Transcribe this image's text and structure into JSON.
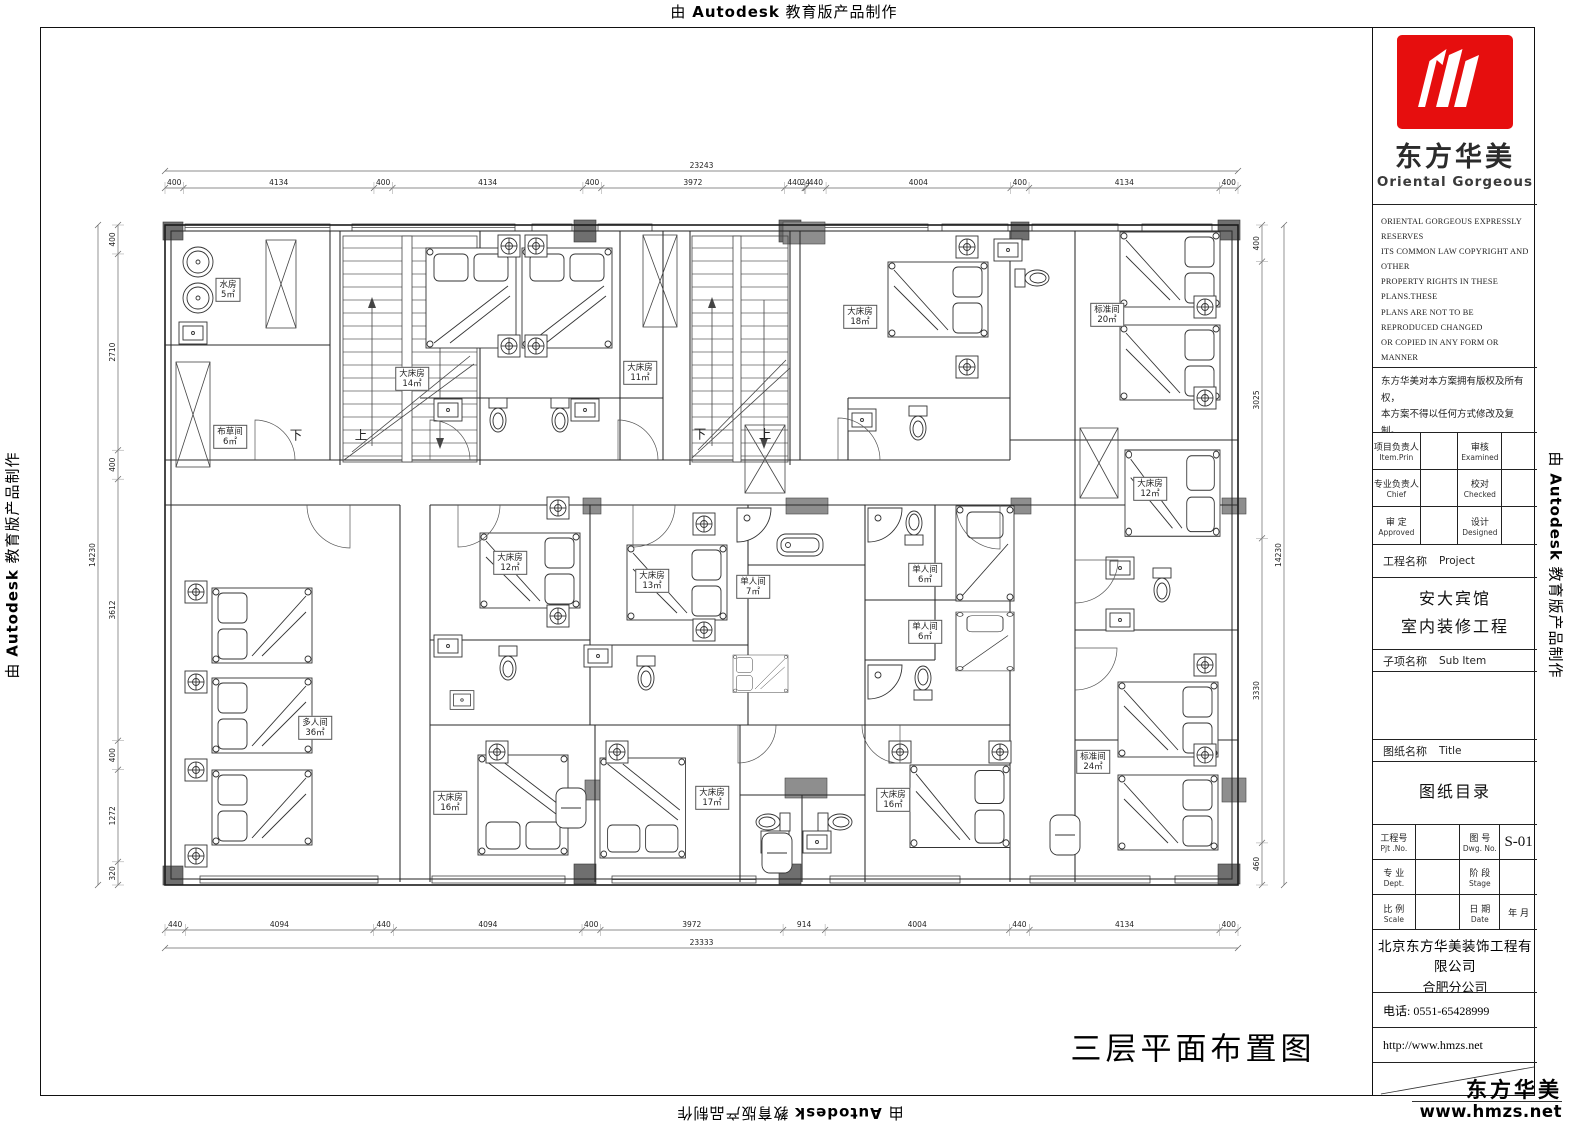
{
  "watermark": {
    "prefix": "由 ",
    "brand": "Autodesk",
    "suffix": " 教育版产品制作"
  },
  "logo": {
    "cn": "东方华美",
    "en": "Oriental Gorgeous"
  },
  "copyright_en": [
    "ORIENTAL GORGEOUS EXPRESSLY RESERVES",
    "ITS COMMON LAW COPYRIGHT AND OTHER",
    "PROPERTY RIGHTS IN THESE PLANS.THESE",
    "PLANS ARE NOT TO BE REPRODUCED CHANGED",
    "OR COPIED IN ANY FORM OR MANNER",
    "WHATSOEVER,NOR ARE THEY TO BE ASSIGNED",
    "TO ANY THIRD PARTY WITHOUT FIRST",
    "OBTAINING THE EXPRESSED WRITTEN",
    "PERMISSION AND CONSENT OF ORIENTAL",
    "GORGEOUS"
  ],
  "copyright_cn": [
    "东方华美对本方案拥有版权及所有权，",
    "本方案不得以任何方式修改及复制。",
    "未经东方华美书面授权，本方案不得向",
    "任何第三方转让。"
  ],
  "personnel": {
    "item_prin_cn": "项目负责人",
    "item_prin_en": "Item.Prin",
    "examined_cn": "审核",
    "examined_en": "Examined",
    "chief_cn": "专业负责人",
    "chief_en": "Chief",
    "checked_cn": "校对",
    "checked_en": "Checked",
    "approved_cn": "审 定",
    "approved_en": "Approved",
    "designed_cn": "设计",
    "designed_en": "Designed"
  },
  "project": {
    "label_cn": "工程名称",
    "label_en": "Project",
    "name_line1": "安大宾馆",
    "name_line2": "室内装修工程"
  },
  "sub_item": {
    "label_cn": "子项名称",
    "label_en": "Sub Item"
  },
  "sheet": {
    "label_cn": "图纸名称",
    "label_en": "Title",
    "title": "图纸目录"
  },
  "titleblock": {
    "pjt_cn": "工程号",
    "pjt_en": "Pjt .No.",
    "dwg_cn": "图 号",
    "dwg_en": "Dwg. No.",
    "dwg_no": "S-01",
    "dept_cn": "专 业",
    "dept_en": "Dept.",
    "stage_cn": "阶 段",
    "stage_en": "Stage",
    "scale_cn": "比 例",
    "scale_en": "Scale",
    "date_cn": "日 期",
    "date_en": "Date",
    "date_val": "年    月"
  },
  "company": {
    "name": "北京东方华美装饰工程有限公司",
    "branch": "合肥分公司",
    "address": "安徽省合肥市马鞍山南路绿地赢海大厦B座19楼",
    "tel": "电话: 0551-65428999",
    "web": "http://www.hmzs.net"
  },
  "brand_corner": {
    "cn": "东方华美",
    "url": "www.hmzs.net"
  },
  "plan": {
    "caption": "三层平面布置图",
    "rooms": [
      {
        "name": "水房",
        "area": "5㎡",
        "x": 228,
        "y": 290
      },
      {
        "name": "布草间",
        "area": "6㎡",
        "x": 230,
        "y": 437
      },
      {
        "name": "大床房",
        "area": "14㎡",
        "x": 412,
        "y": 379
      },
      {
        "name": "大床房",
        "area": "11㎡",
        "x": 640,
        "y": 373
      },
      {
        "name": "大床房",
        "area": "18㎡",
        "x": 860,
        "y": 317
      },
      {
        "name": "标准间",
        "area": "20㎡",
        "x": 1107,
        "y": 315
      },
      {
        "name": "大床房",
        "area": "12㎡",
        "x": 1150,
        "y": 489
      },
      {
        "name": "大床房",
        "area": "12㎡",
        "x": 510,
        "y": 563
      },
      {
        "name": "大床房",
        "area": "13㎡",
        "x": 652,
        "y": 581
      },
      {
        "name": "单人间",
        "area": "7㎡",
        "x": 753,
        "y": 587
      },
      {
        "name": "单人间",
        "area": "6㎡",
        "x": 925,
        "y": 575
      },
      {
        "name": "单人间",
        "area": "6㎡",
        "x": 925,
        "y": 632
      },
      {
        "name": "多人间",
        "area": "36㎡",
        "x": 315,
        "y": 728
      },
      {
        "name": "大床房",
        "area": "16㎡",
        "x": 450,
        "y": 803
      },
      {
        "name": "大床房",
        "area": "17㎡",
        "x": 712,
        "y": 798
      },
      {
        "name": "大床房",
        "area": "16㎡",
        "x": 893,
        "y": 800
      },
      {
        "name": "标准间",
        "area": "24㎡",
        "x": 1093,
        "y": 762
      }
    ],
    "stair_labels": [
      {
        "text": "下",
        "x": 296,
        "y": 434
      },
      {
        "text": "上",
        "x": 361,
        "y": 434
      },
      {
        "text": "下",
        "x": 700,
        "y": 433
      },
      {
        "text": "上",
        "x": 765,
        "y": 433
      }
    ],
    "dims": {
      "top": {
        "segments": [
          "400",
          "4134",
          "400",
          "4134",
          "400",
          "3972",
          "440",
          "24",
          "440",
          "4004",
          "400",
          "4134",
          "400"
        ],
        "total": "23243"
      },
      "bottom": {
        "segments": [
          "440",
          "4094",
          "440",
          "4094",
          "400",
          "3972",
          "914",
          "4004",
          "440",
          "4134",
          "400"
        ],
        "total": "23333"
      },
      "left": {
        "segments": [
          "400",
          "2710",
          "400",
          "3612",
          "400",
          "1272",
          "320"
        ],
        "total": "14230"
      },
      "right": {
        "segments": [
          "400",
          "3025",
          "3330",
          "460"
        ],
        "total": "14230"
      }
    }
  }
}
